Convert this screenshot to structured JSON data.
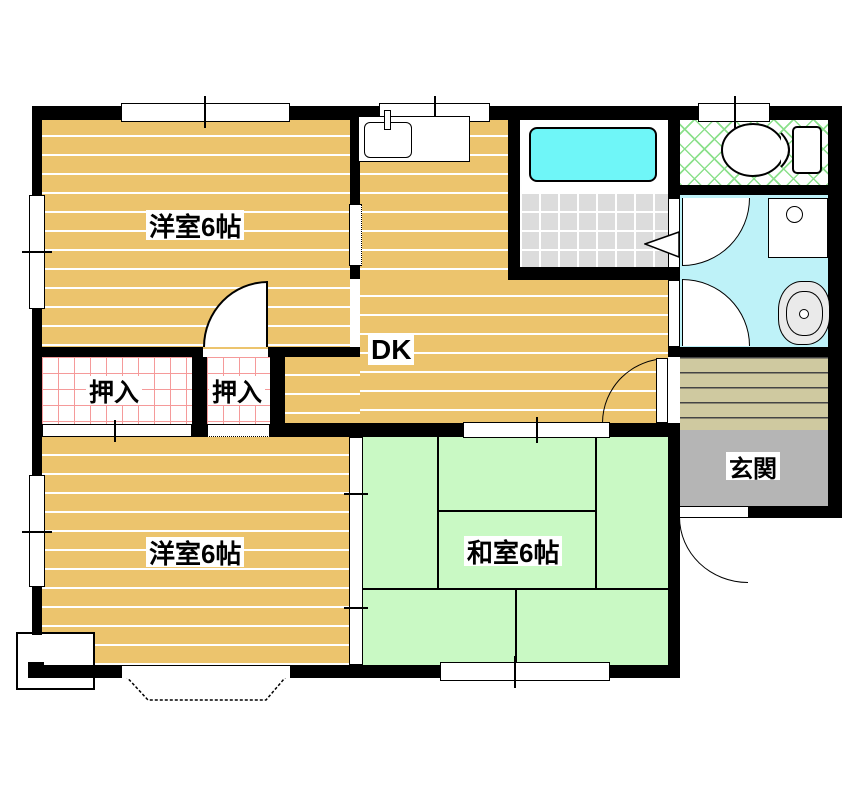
{
  "labels": {
    "western_room_top": "洋室6帖",
    "western_room_bottom": "洋室6帖",
    "japanese_room": "和室6帖",
    "dining_kitchen": "DK",
    "closet_left": "押入",
    "closet_right": "押入",
    "entrance": "玄関"
  },
  "colors": {
    "wall": "#000000",
    "wood-floor": "#ecc46d",
    "tatami": "#c9f9c4",
    "bathtub": "#6ff6f8",
    "washroom-floor": "#bef2f8",
    "tile-floor": "#dcdcdc",
    "entrance-floor": "#b5b5b5",
    "step-floor": "#cfc9a0",
    "closet-grid": "#f59a9a",
    "toilet-lattice": "#8ce08c"
  }
}
